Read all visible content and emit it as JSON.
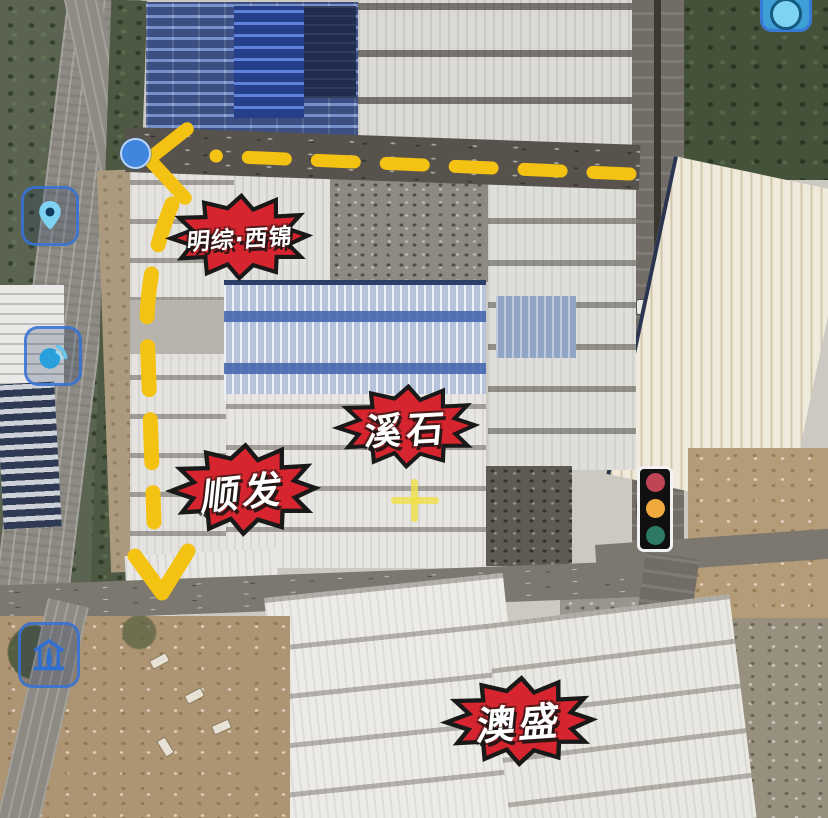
{
  "app": {
    "type": "annotated-satellite-map"
  },
  "badges": [
    {
      "id": "badge-mingzong-xijin",
      "label": "明综·西锦"
    },
    {
      "id": "badge-xishi",
      "label": "溪石"
    },
    {
      "id": "badge-shunfa",
      "label": "顺发"
    },
    {
      "id": "badge-aosheng",
      "label": "澳盛"
    }
  ],
  "badge_style": {
    "fill": "#D6252F",
    "outline": "#191919",
    "text_color": "#FFFFFF"
  },
  "route": {
    "color": "#F4C213",
    "style": "dashed",
    "origin_marker": "blue-dot",
    "end_marker": "down-arrow",
    "blue_dot_color": "#3F87DE"
  },
  "map_icons": [
    {
      "name": "location-pin-icon"
    },
    {
      "name": "signal-icon"
    },
    {
      "name": "building-icon"
    },
    {
      "name": "camera-icon"
    }
  ],
  "traffic_light": {
    "red": "#BF4456",
    "amber": "#F0A93C",
    "green": "#2D7A64"
  },
  "crosshair": {
    "color": "#EEDC46"
  }
}
